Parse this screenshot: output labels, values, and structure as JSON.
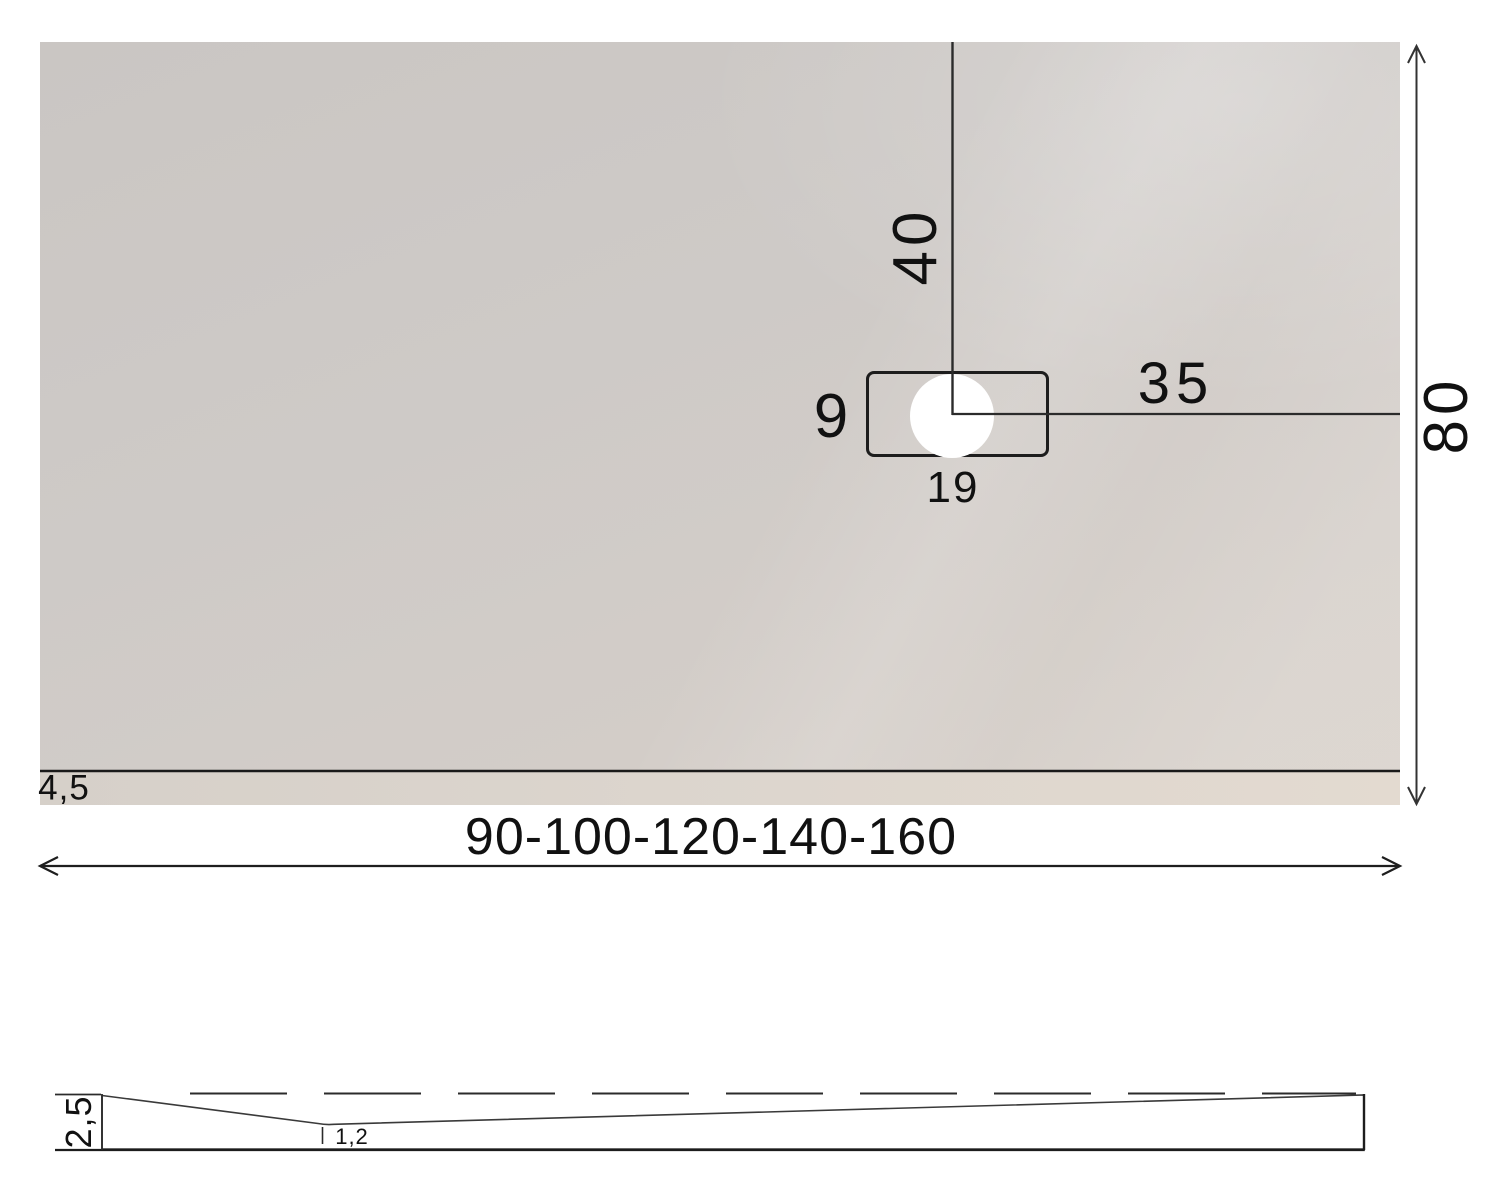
{
  "drawing": {
    "type": "shower-tray-technical-drawing",
    "views": {
      "top_view": "plan view of shower tray with drain",
      "side_view": "section profile with slope to drain"
    }
  },
  "colors": {
    "background": "#ffffff",
    "surface_light": "#d8d1ca",
    "surface_dark": "#cac6c3",
    "line": "#222222",
    "drain_fill": "#ffffff"
  },
  "dimensions": {
    "drain_offset_from_top": "40",
    "drain_offset_from_right": "35",
    "drain_cover_height": "9",
    "drain_cover_width": "19",
    "tray_depth": "80",
    "edge_border_thickness": "4,5",
    "width_options": "90-100-120-140-160",
    "profile_edge_height": "2,5",
    "profile_min_thickness": "1,2"
  }
}
